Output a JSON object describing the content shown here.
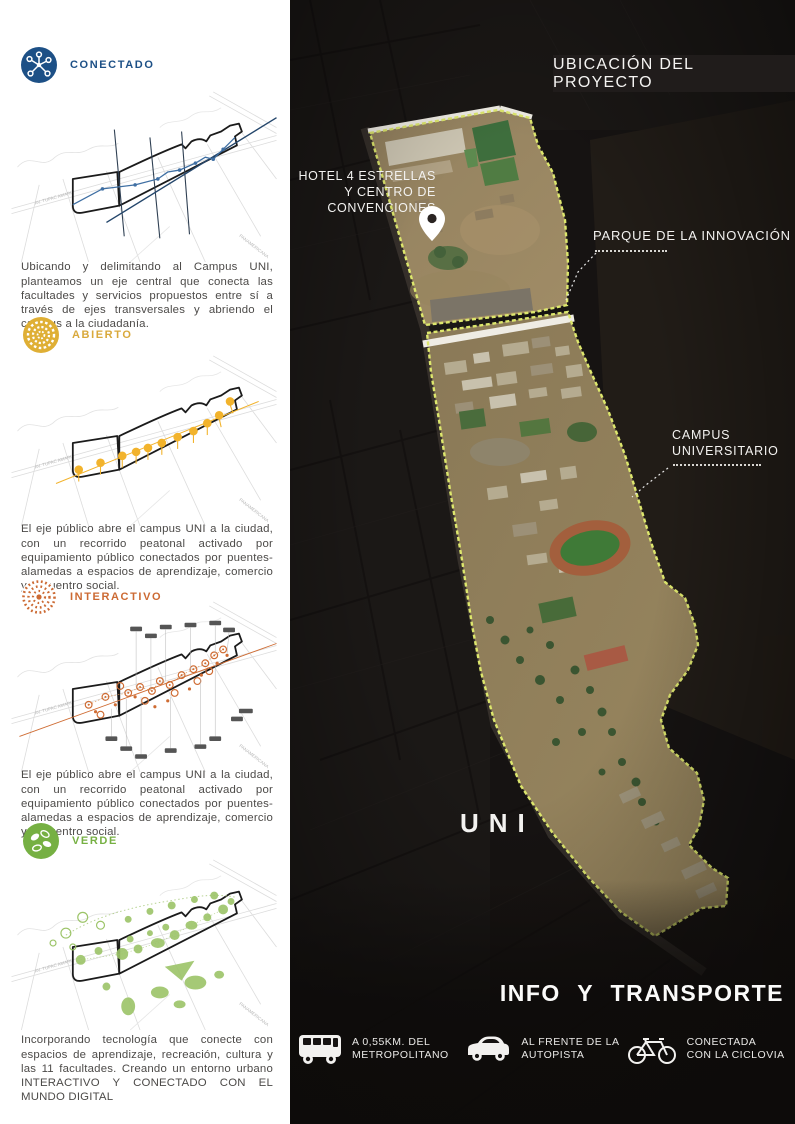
{
  "left": {
    "sections": [
      {
        "icon": "network-icon",
        "label": "CONECTADO",
        "color": "#1d5086",
        "paragraph": "Ubicando y delimitando al Campus UNI, planteamos un eje central que conecta las facultades y servicios propuestos entre sí a través de ejes transversales y abriendo el campus a la ciudadanía."
      },
      {
        "icon": "sun-icon",
        "label": "ABIERTO",
        "color": "#d9a93c",
        "paragraph": "El eje público abre el campus UNI a la ciudad, con un recorrido peatonal activado por equipamiento público conectados por puentes-alamedas a espacios de aprendizaje, comercio y encuentro social."
      },
      {
        "icon": "dotted-rings-icon",
        "label": "INTERACTIVO",
        "color": "#cc6a33",
        "paragraph": "El eje público abre el campus UNI a la ciudad, con un recorrido peatonal activado por equipamiento público conectados por puentes-alamedas a espacios de aprendizaje, comercio y encuentro social."
      },
      {
        "icon": "leaves-icon",
        "label": "VERDE",
        "color": "#76b043",
        "paragraph": "Incorporando tecnología que conecte con espacios de aprendizaje, recreación, cultura y las 11 facultades. Creando un entorno urbano INTERACTIVO Y CONECTADO CON EL MUNDO DIGITAL"
      }
    ],
    "road_labels": {
      "avenue": "AV. TUPAC AMARU",
      "highway": "PANAMERICANA"
    }
  },
  "map": {
    "header": "UBICACIÓN DEL PROYECTO",
    "hotel_label": "HOTEL 4 ESTRELLAS\nY CENTRO DE\nCONVENCIONES",
    "parque_label": "PARQUE DE LA INNOVACIÓN",
    "campus_label": "CAMPUS\nUNIVERSITARIO",
    "uni_label": "UNI",
    "info_heading": "INFO  Y  TRANSPORTE",
    "pin": "map-pin-icon",
    "boundary_color": "#dde76d",
    "transport": [
      {
        "icon": "bus-icon",
        "label": "A 0,55KM. DEL\nMETROPOLITANO"
      },
      {
        "icon": "car-icon",
        "label": "AL FRENTE DE LA\nAUTOPISTA"
      },
      {
        "icon": "bicycle-icon",
        "label": "CONECTADA\nCON LA CICLOVIA"
      }
    ]
  }
}
